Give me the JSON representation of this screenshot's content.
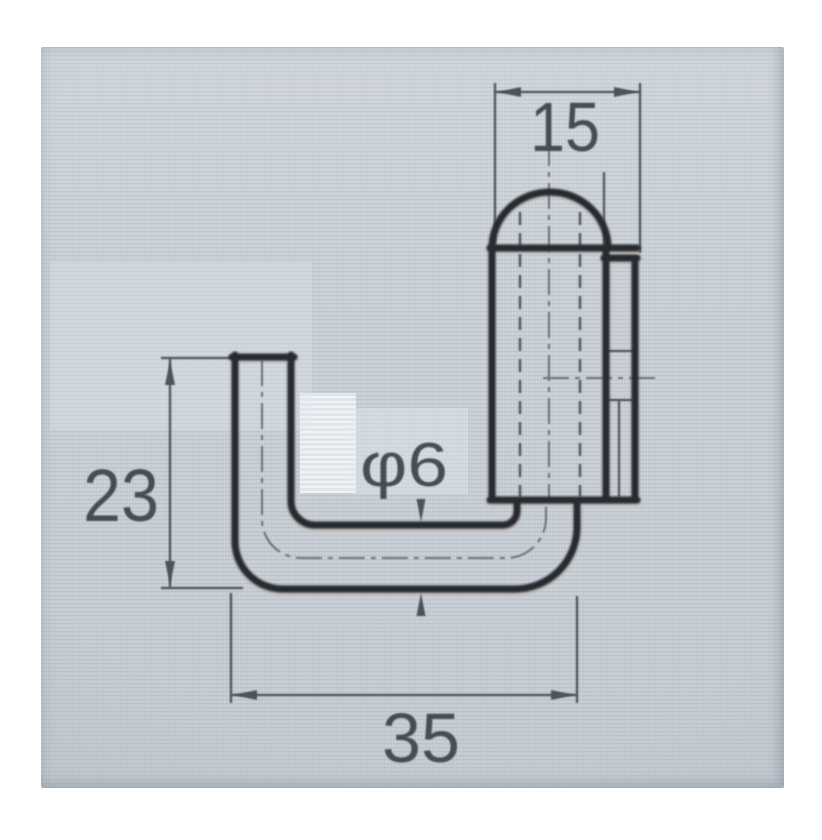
{
  "drawing": {
    "labels": {
      "top_width": "15",
      "left_height": "23",
      "rod_diameter": "φ6",
      "bottom_width": "35"
    },
    "colors": {
      "page_background": "#ffffff",
      "photo_background": "#ccd3d9",
      "part_outline": "#262b33",
      "dimension_lines": "#4d535d",
      "label_text": "#474d57"
    }
  }
}
